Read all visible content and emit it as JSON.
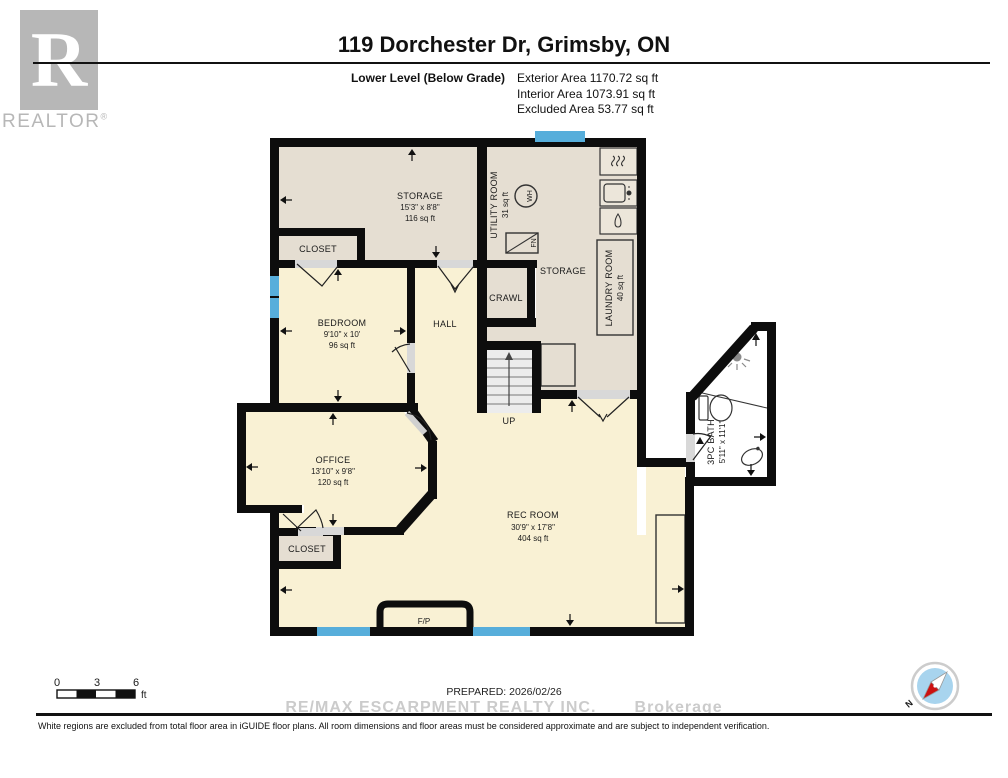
{
  "header": {
    "title": "119 Dorchester Dr, Grimsby, ON",
    "level_label": "Lower Level (Below Grade)",
    "exterior_area": "Exterior Area 1170.72 sq ft",
    "interior_area": "Interior Area 1073.91 sq ft",
    "excluded_area": "Excluded Area 53.77 sq ft"
  },
  "logo": {
    "letter": "R",
    "wordmark": "REALTOR",
    "registered": "®"
  },
  "rooms": {
    "storage_top": {
      "name": "STORAGE",
      "dims": "15'3\" x 8'8\"",
      "area": "116 sq ft"
    },
    "closet_top": {
      "name": "CLOSET"
    },
    "utility": {
      "name": "UTILITY ROOM",
      "area": "31 sq ft"
    },
    "storage_right": {
      "name": "STORAGE"
    },
    "laundry": {
      "name": "LAUNDRY ROOM",
      "area": "40 sq ft"
    },
    "crawl": {
      "name": "CRAWL"
    },
    "hall": {
      "name": "HALL"
    },
    "bedroom": {
      "name": "BEDROOM",
      "dims": "9'10\" x 10'",
      "area": "96 sq ft"
    },
    "office": {
      "name": "OFFICE",
      "dims": "13'10\" x 9'8\"",
      "area": "120 sq ft"
    },
    "rec_room": {
      "name": "REC ROOM",
      "dims": "30'9\" x 17'8\"",
      "area": "404 sq ft"
    },
    "closet_bottom": {
      "name": "CLOSET"
    },
    "bath": {
      "name": "3PC BATH",
      "dims": "5'11\" x 11'1\""
    }
  },
  "fixtures": {
    "water_heater": "WH",
    "furnace": "FN",
    "stairs_up": "UP",
    "fireplace": "F/P"
  },
  "scale_bar": {
    "t0": "0",
    "t3": "3",
    "t6": "6",
    "unit": "ft"
  },
  "compass": {
    "north": "N"
  },
  "footer": {
    "prepared": "PREPARED: 2026/02/26",
    "watermark": "RE/MAX ESCARPMENT REALTY INC.       Brokerage",
    "disclaimer": "White regions are excluded from total floor area in iGUIDE floor plans. All room dimensions and floor areas must be considered approximate and are subject to independent verification."
  },
  "colors": {
    "wall": "#0d0d0d",
    "floor_cream": "#f9f1d4",
    "floor_gray": "#e5ded2",
    "window_blue": "#57aedb",
    "door_gap": "#d8d8d8",
    "watermark_gray": "#cbcbcb",
    "logo_gray": "#b7b7b7"
  }
}
